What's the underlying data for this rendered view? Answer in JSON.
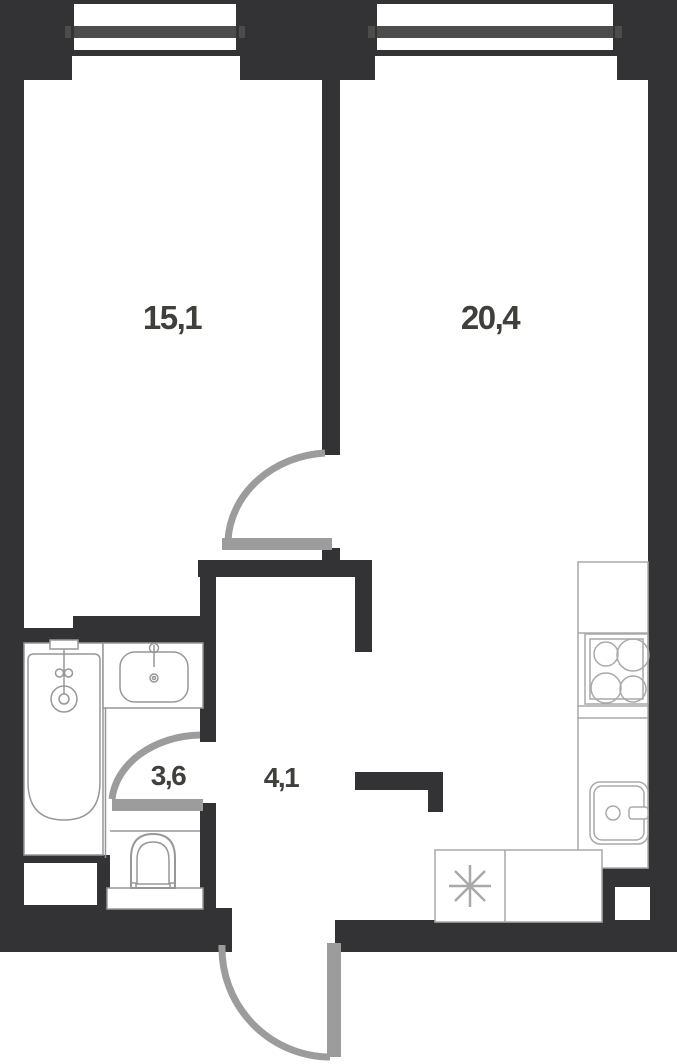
{
  "plan": {
    "type": "apartment-floor-plan",
    "rooms": [
      {
        "id": "bedroom",
        "area_label": "15,1"
      },
      {
        "id": "living-kitchen",
        "area_label": "20,4"
      },
      {
        "id": "bathroom",
        "area_label": "3,6"
      },
      {
        "id": "hallway",
        "area_label": "4,1"
      }
    ],
    "colors": {
      "wall": "#333336",
      "window_bar": "#4c4c4a",
      "fixture_outline": "#979797",
      "kitchen_outline": "#a9a9a9",
      "door_arc": "#9c9c9c",
      "label": "#3f3f3c",
      "background": "#ffffff"
    }
  }
}
